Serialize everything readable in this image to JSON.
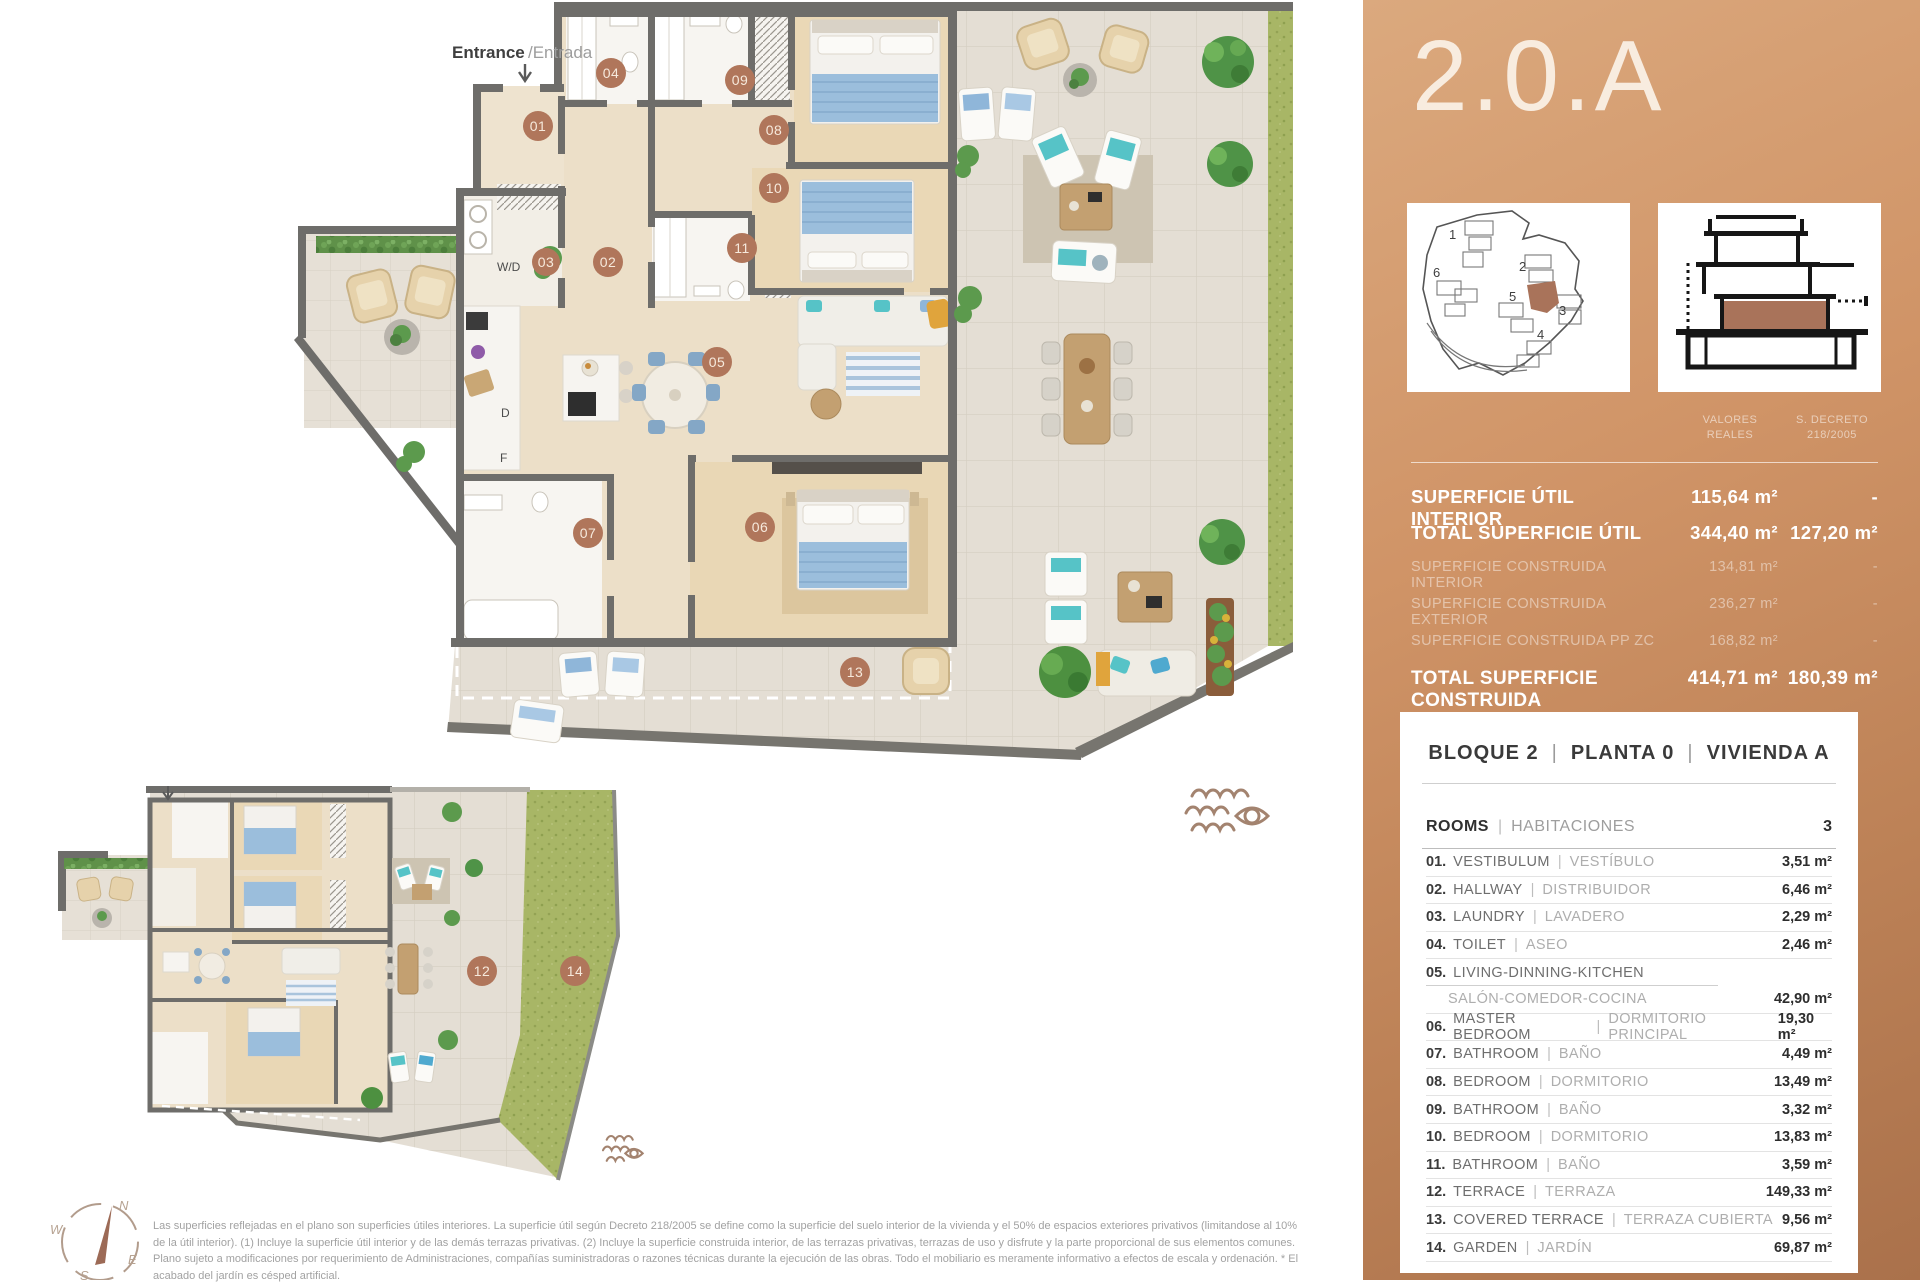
{
  "title": "2.0.A",
  "panel": {
    "accent": "#b0765b",
    "copper_top": "#dba97e",
    "copper_bottom": "#aa714b",
    "col1": "VALORES\nREALES",
    "col2": "S. DECRETO\n218/2005",
    "surfaces": [
      {
        "label": "SUPERFICIE ÚTIL INTERIOR",
        "v1": "115,64 m²",
        "v2": "-",
        "strong": true
      },
      {
        "label": "TOTAL SUPERFICIE ÚTIL",
        "v1": "344,40 m²",
        "v2": "127,20 m²",
        "strong": true
      },
      {
        "label": "SUPERFICIE CONSTRUIDA INTERIOR",
        "v1": "134,81 m²",
        "v2": "-",
        "strong": false
      },
      {
        "label": "SUPERFICIE CONSTRUIDA EXTERIOR",
        "v1": "236,27 m²",
        "v2": "-",
        "strong": false
      },
      {
        "label": "SUPERFICIE CONSTRUIDA PP ZC",
        "v1": "168,82 m²",
        "v2": "-",
        "strong": false
      },
      {
        "label": "TOTAL SUPERFICIE CONSTRUIDA",
        "v1": "414,71 m²",
        "v2": "180,39 m²",
        "strong": true
      }
    ],
    "sep": "|",
    "card": {
      "heading1": "BLOQUE 2",
      "heading2": "PLANTA 0",
      "heading3": "VIVIENDA A",
      "rooms_en": "ROOMS",
      "rooms_es": "HABITACIONES",
      "rooms_count": "3",
      "rooms": [
        {
          "num": "01.",
          "en": "VESTIBULUM",
          "es": "VESTÍBULO",
          "area": "3,51 m²"
        },
        {
          "num": "02.",
          "en": "HALLWAY",
          "es": "DISTRIBUIDOR",
          "area": "6,46 m²"
        },
        {
          "num": "03.",
          "en": "LAUNDRY",
          "es": "LAVADERO",
          "area": "2,29 m²"
        },
        {
          "num": "04.",
          "en": "TOILET",
          "es": "ASEO",
          "area": "2,46 m²"
        },
        {
          "num": "05.",
          "en": "LIVING-DINNING-KITCHEN",
          "es": "SALÓN-COMEDOR-COCINA",
          "area": "42,90 m²"
        },
        {
          "num": "06.",
          "en": "MASTER BEDROOM",
          "es": "DORMITORIO PRINCIPAL",
          "area": "19,30 m²"
        },
        {
          "num": "07.",
          "en": "BATHROOM",
          "es": "BAÑO",
          "area": "4,49 m²"
        },
        {
          "num": "08.",
          "en": "BEDROOM",
          "es": "DORMITORIO",
          "area": "13,49 m²"
        },
        {
          "num": "09.",
          "en": "BATHROOM",
          "es": "BAÑO",
          "area": "3,32 m²"
        },
        {
          "num": "10.",
          "en": "BEDROOM",
          "es": "DORMITORIO",
          "area": "13,83 m²"
        },
        {
          "num": "11.",
          "en": "BATHROOM",
          "es": "BAÑO",
          "area": "3,59 m²"
        },
        {
          "num": "12.",
          "en": "TERRACE",
          "es": "TERRAZA",
          "area": "149,33 m²"
        },
        {
          "num": "13.",
          "en": "COVERED TERRACE",
          "es": "TERRAZA CUBIERTA",
          "area": "9,56 m²"
        },
        {
          "num": "14.",
          "en": "GARDEN",
          "es": "JARDÍN",
          "area": "69,87 m²"
        }
      ]
    }
  },
  "plan": {
    "entrance_en": "Entrance",
    "entrance_es": "/Entrada",
    "labels": {
      "wd": "W/D",
      "d": "D",
      "f": "F"
    },
    "badges": {
      "n01": "01",
      "n02": "02",
      "n03": "03",
      "n04": "04",
      "n05": "05",
      "n06": "06",
      "n07": "07",
      "n08": "08",
      "n09": "09",
      "n10": "10",
      "n11": "11",
      "n12": "12",
      "n13": "13",
      "n14": "14"
    },
    "compass": {
      "n": "N",
      "w": "W",
      "e": "E",
      "s": "S"
    },
    "site_numbers": {
      "b1": "1",
      "b2": "2",
      "b3": "3",
      "b4": "4",
      "b5": "5",
      "b6": "6"
    }
  },
  "disclaimer": "Las superficies reflejadas en el plano son superficies útiles interiores. La superficie útil según Decreto 218/2005 se define como la superficie del suelo interior de la vivienda y el 50% de espacios exteriores privativos (limitandose al 10% de la útil interior). (1) Incluye la superficie útil interior y de las demás terrazas privativas. (2) Incluye la superficie construida interior, de las terrazas privativas, terrazas de uso y disfrute y la parte proporcional de sus elementos comunes. Plano sujeto a modificaciones por requerimiento de Administraciones, compañías suministradoras o razones técnicas durante la ejecución de las obras. Todo el mobiliario es meramente informativo a efectos de escala y ordenación. * El acabado del jardín es césped artificial."
}
